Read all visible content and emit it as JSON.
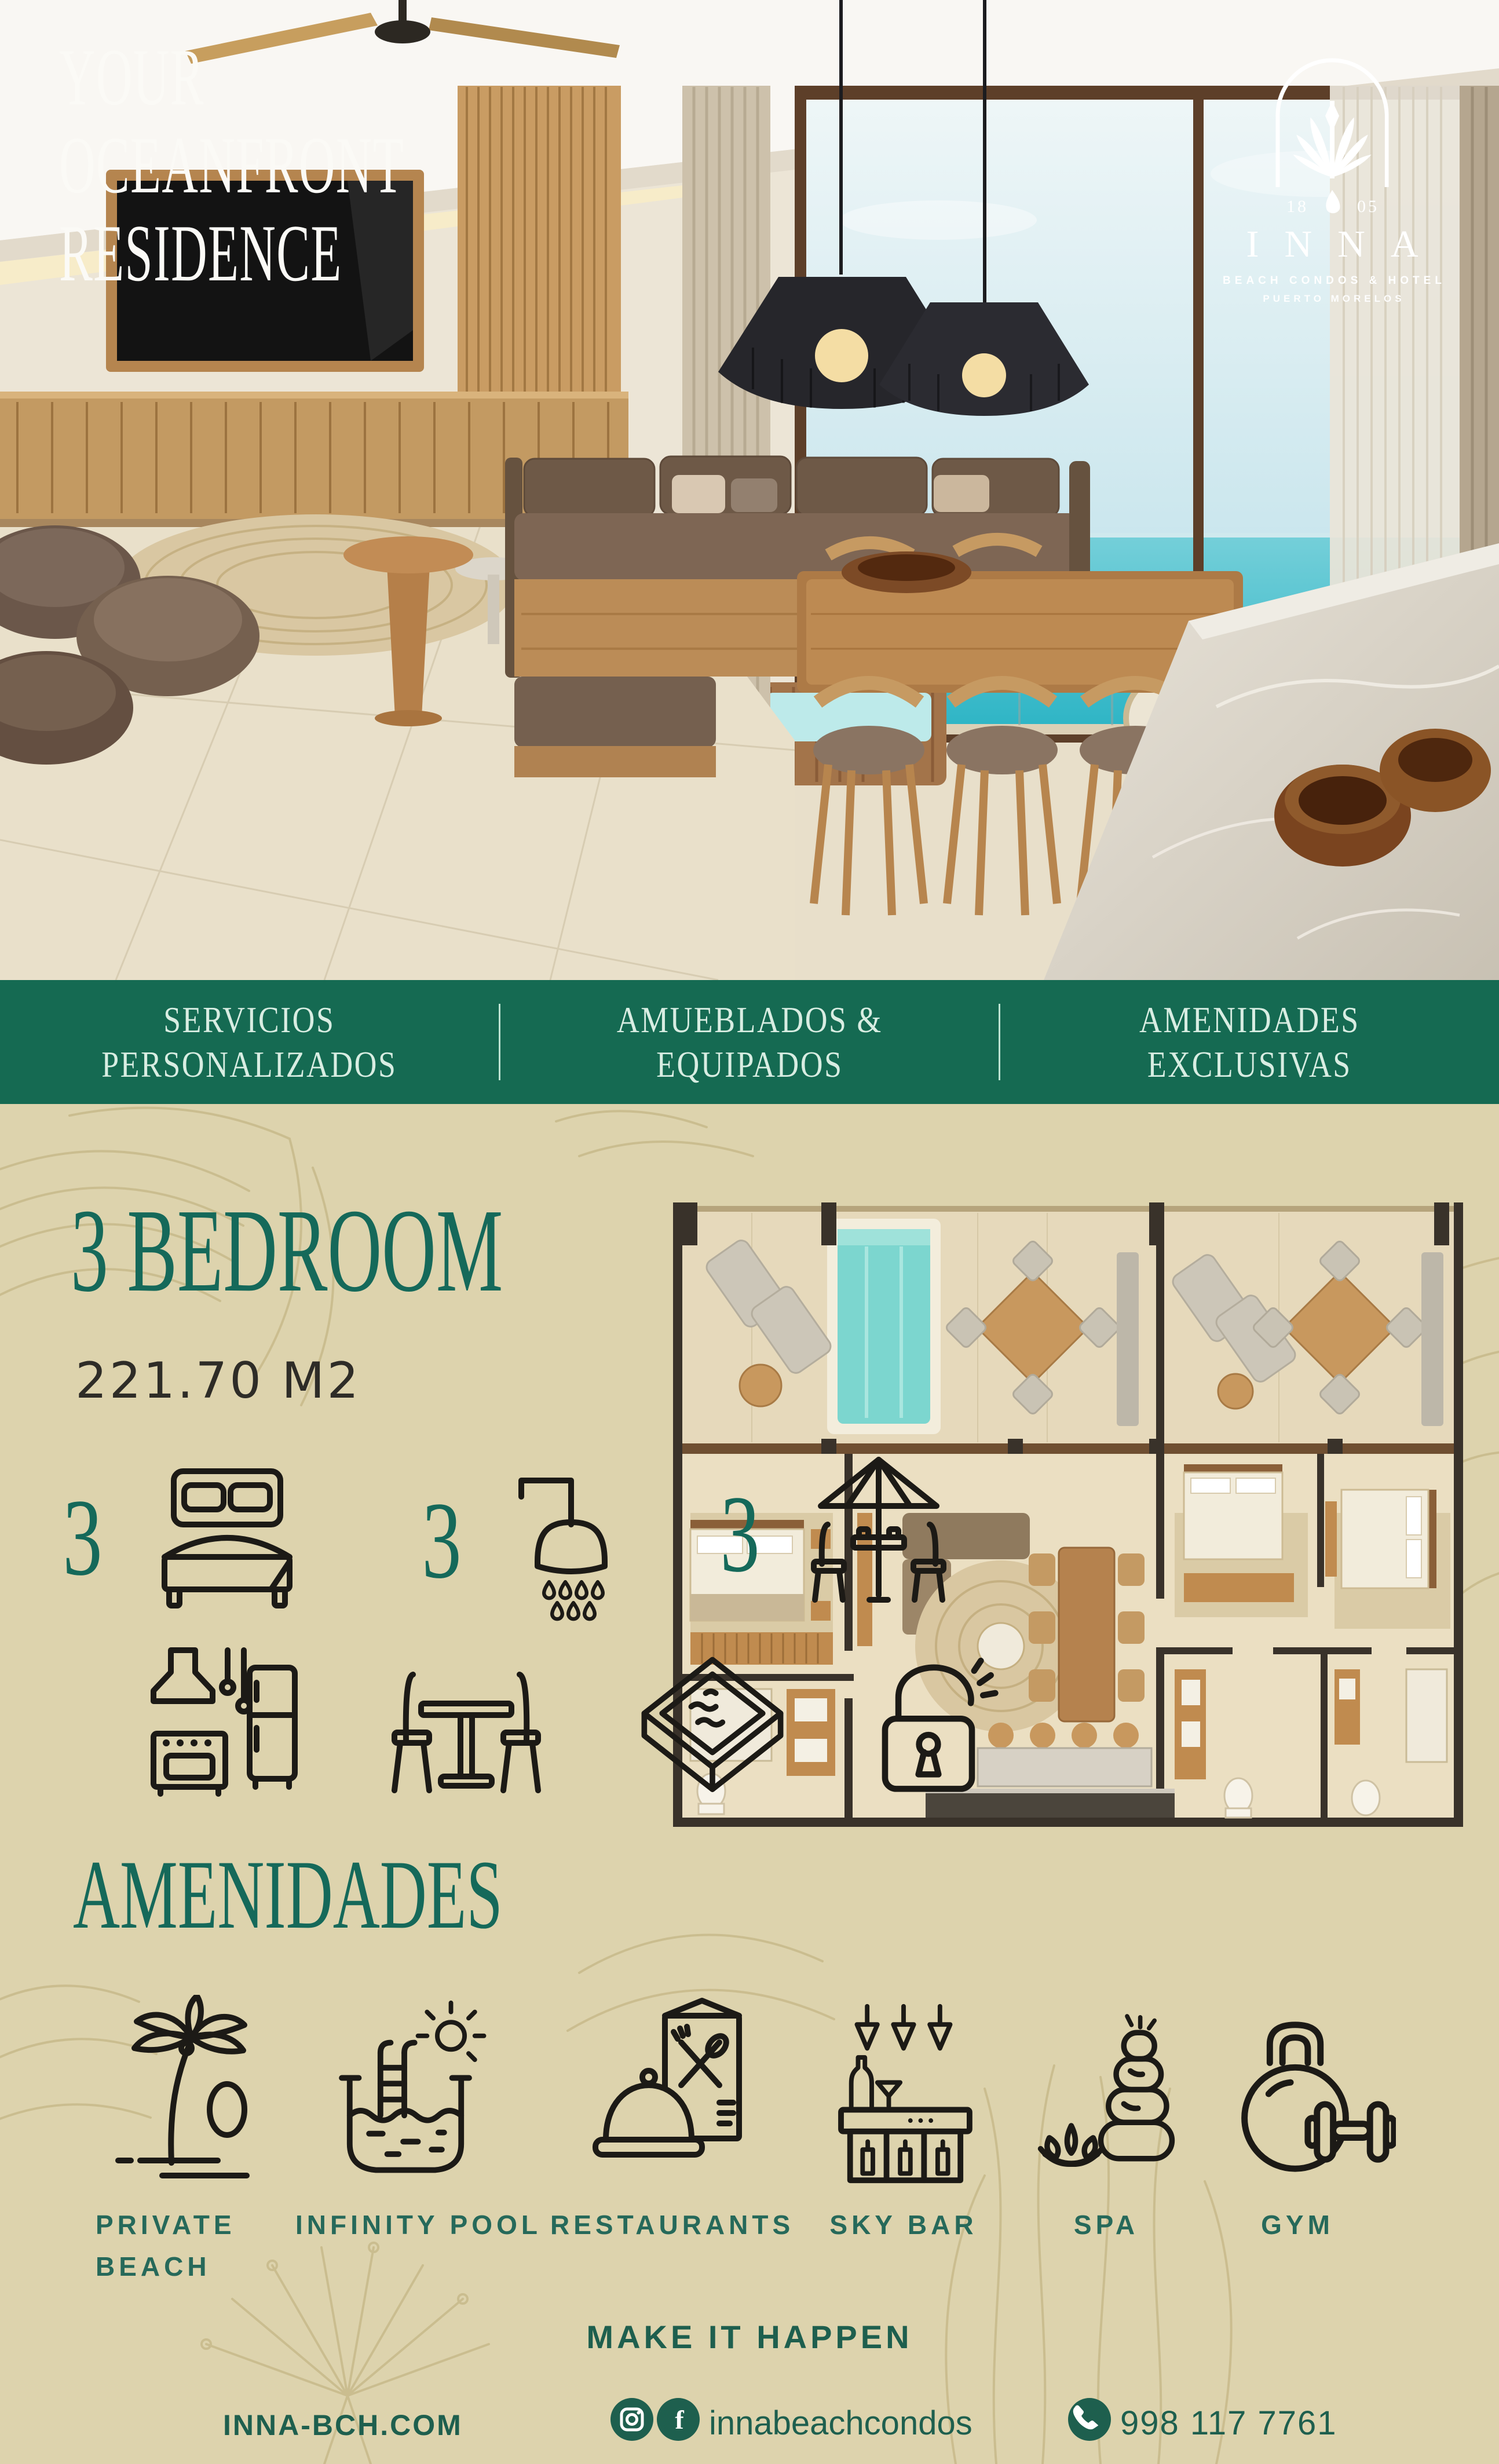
{
  "hero": {
    "title_lines": [
      "YOUR",
      "OCEANFRONT",
      "RESIDENCE"
    ],
    "logo": {
      "year_left": "18",
      "year_right": "05",
      "name": "INNA",
      "tagline": "BEACH CONDOS & HOTEL",
      "location": "PUERTO MORELOS"
    }
  },
  "banner": {
    "items": [
      {
        "line1": "SERVICIOS",
        "line2": "PERSONALIZADOS"
      },
      {
        "line1": "AMUEBLADOS &",
        "line2": "EQUIPADOS"
      },
      {
        "line1": "AMENIDADES",
        "line2": "EXCLUSIVAS"
      }
    ]
  },
  "unit": {
    "title": "3 BEDROOM",
    "area": "221.70 M2",
    "counts": [
      {
        "value": "3",
        "icon": "bed-icon"
      },
      {
        "value": "3",
        "icon": "shower-icon"
      },
      {
        "value": "3",
        "icon": "terrace-dining-icon"
      }
    ],
    "features": [
      {
        "icon": "kitchen-icon"
      },
      {
        "icon": "dining-table-icon"
      },
      {
        "icon": "plunge-pool-icon"
      },
      {
        "icon": "lock-open-icon"
      }
    ]
  },
  "amenities": {
    "title": "AMENIDADES",
    "items": [
      {
        "label": "PRIVATE BEACH",
        "icon": "private-beach-icon"
      },
      {
        "label": "INFINITY POOL",
        "icon": "infinity-pool-icon"
      },
      {
        "label": "RESTAURANTS",
        "icon": "restaurants-icon"
      },
      {
        "label": "SKY BAR",
        "icon": "sky-bar-icon"
      },
      {
        "label": "SPA",
        "icon": "spa-icon"
      },
      {
        "label": "GYM",
        "icon": "gym-icon"
      }
    ]
  },
  "cta": {
    "text": "MAKE IT HAPPEN"
  },
  "footer": {
    "website": "INNA-BCH.COM",
    "handle": "innabeachcondos",
    "phone": "998 117 7761"
  },
  "colors": {
    "brand_green": "#156A52",
    "banner_text": "#D8EDE2",
    "heading_green": "#15695A",
    "text_dark": "#2E2C27",
    "background_beige": "#DDD3AD",
    "pattern_olive": "#C4B685",
    "icon_black": "#1C1A16",
    "footer_green": "#1E5F4E",
    "ocean_turquoise": "#3FC8D3"
  }
}
